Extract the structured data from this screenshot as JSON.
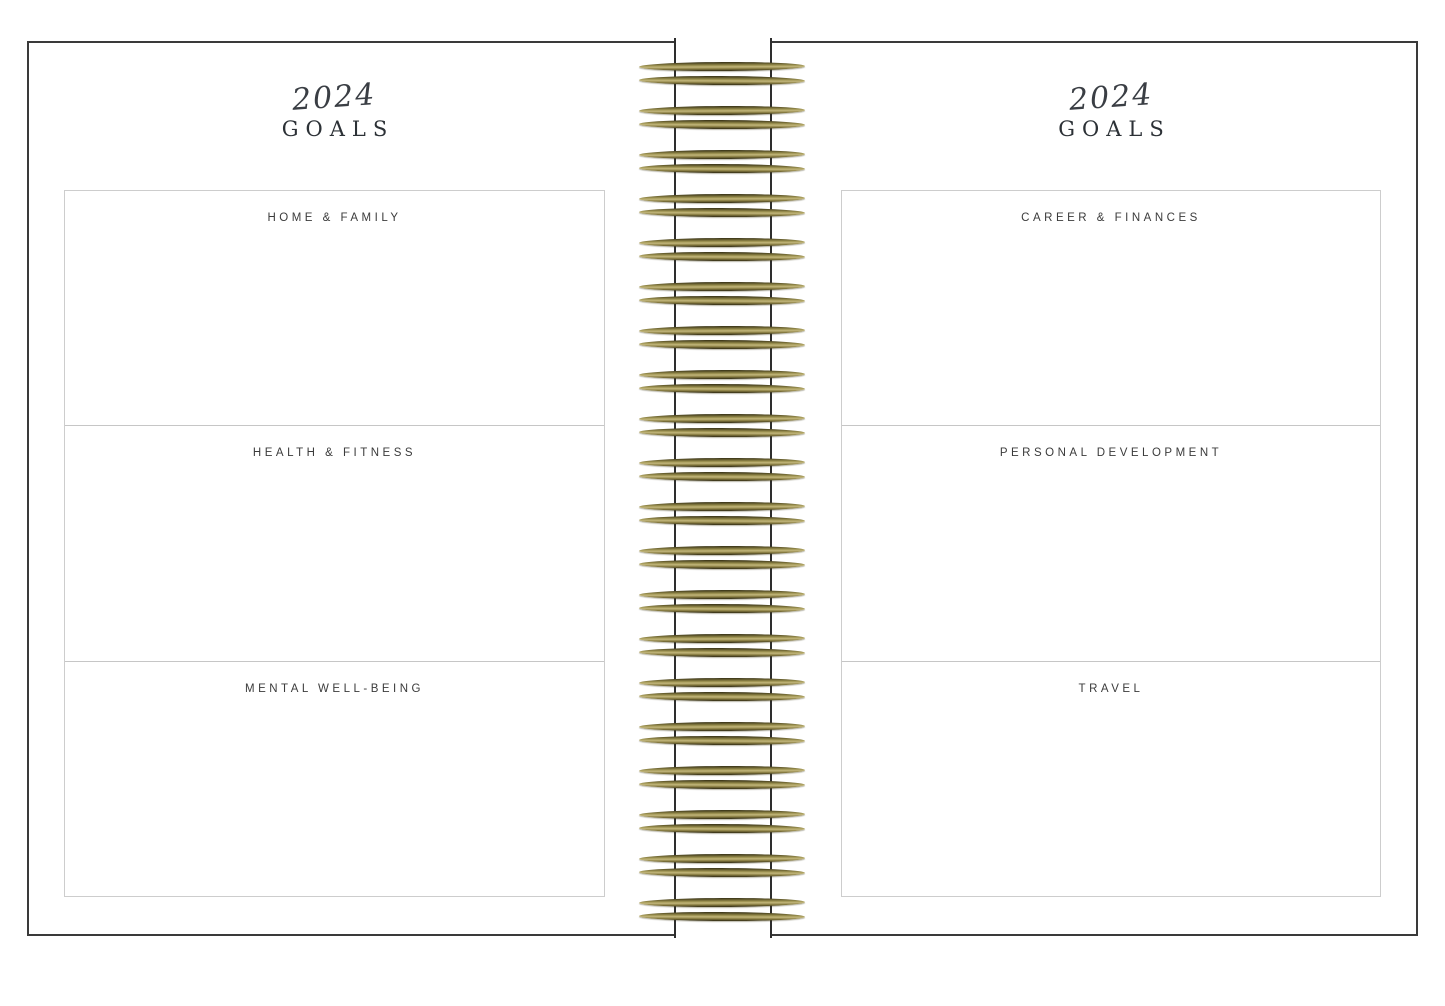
{
  "left_page": {
    "year": "2024",
    "title": "GOALS",
    "sections": [
      {
        "label": "HOME & FAMILY"
      },
      {
        "label": "HEALTH & FITNESS"
      },
      {
        "label": "MENTAL WELL-BEING"
      }
    ]
  },
  "right_page": {
    "year": "2024",
    "title": "GOALS",
    "sections": [
      {
        "label": "CAREER & FINANCES"
      },
      {
        "label": "PERSONAL DEVELOPMENT"
      },
      {
        "label": "TRAVEL"
      }
    ]
  },
  "spiral": {
    "icon": "spiral-binding-coils",
    "coil_pairs": 20,
    "first_pair_y": 62,
    "pair_pitch": 44,
    "bar_gap": 14,
    "color_dark": "#332e15",
    "color_gold": "#a59a58",
    "color_highlight": "#c2b67c"
  },
  "colors": {
    "cover_frame": "#3a3a3a",
    "box_border": "#cdcdcd",
    "divider": "#c6c6c6",
    "label_text": "#3b3b3b",
    "title_text": "#2c3136",
    "year_text": "#3a3e44",
    "gutter_edge": "#2e2e2e",
    "paper": "#ffffff"
  }
}
